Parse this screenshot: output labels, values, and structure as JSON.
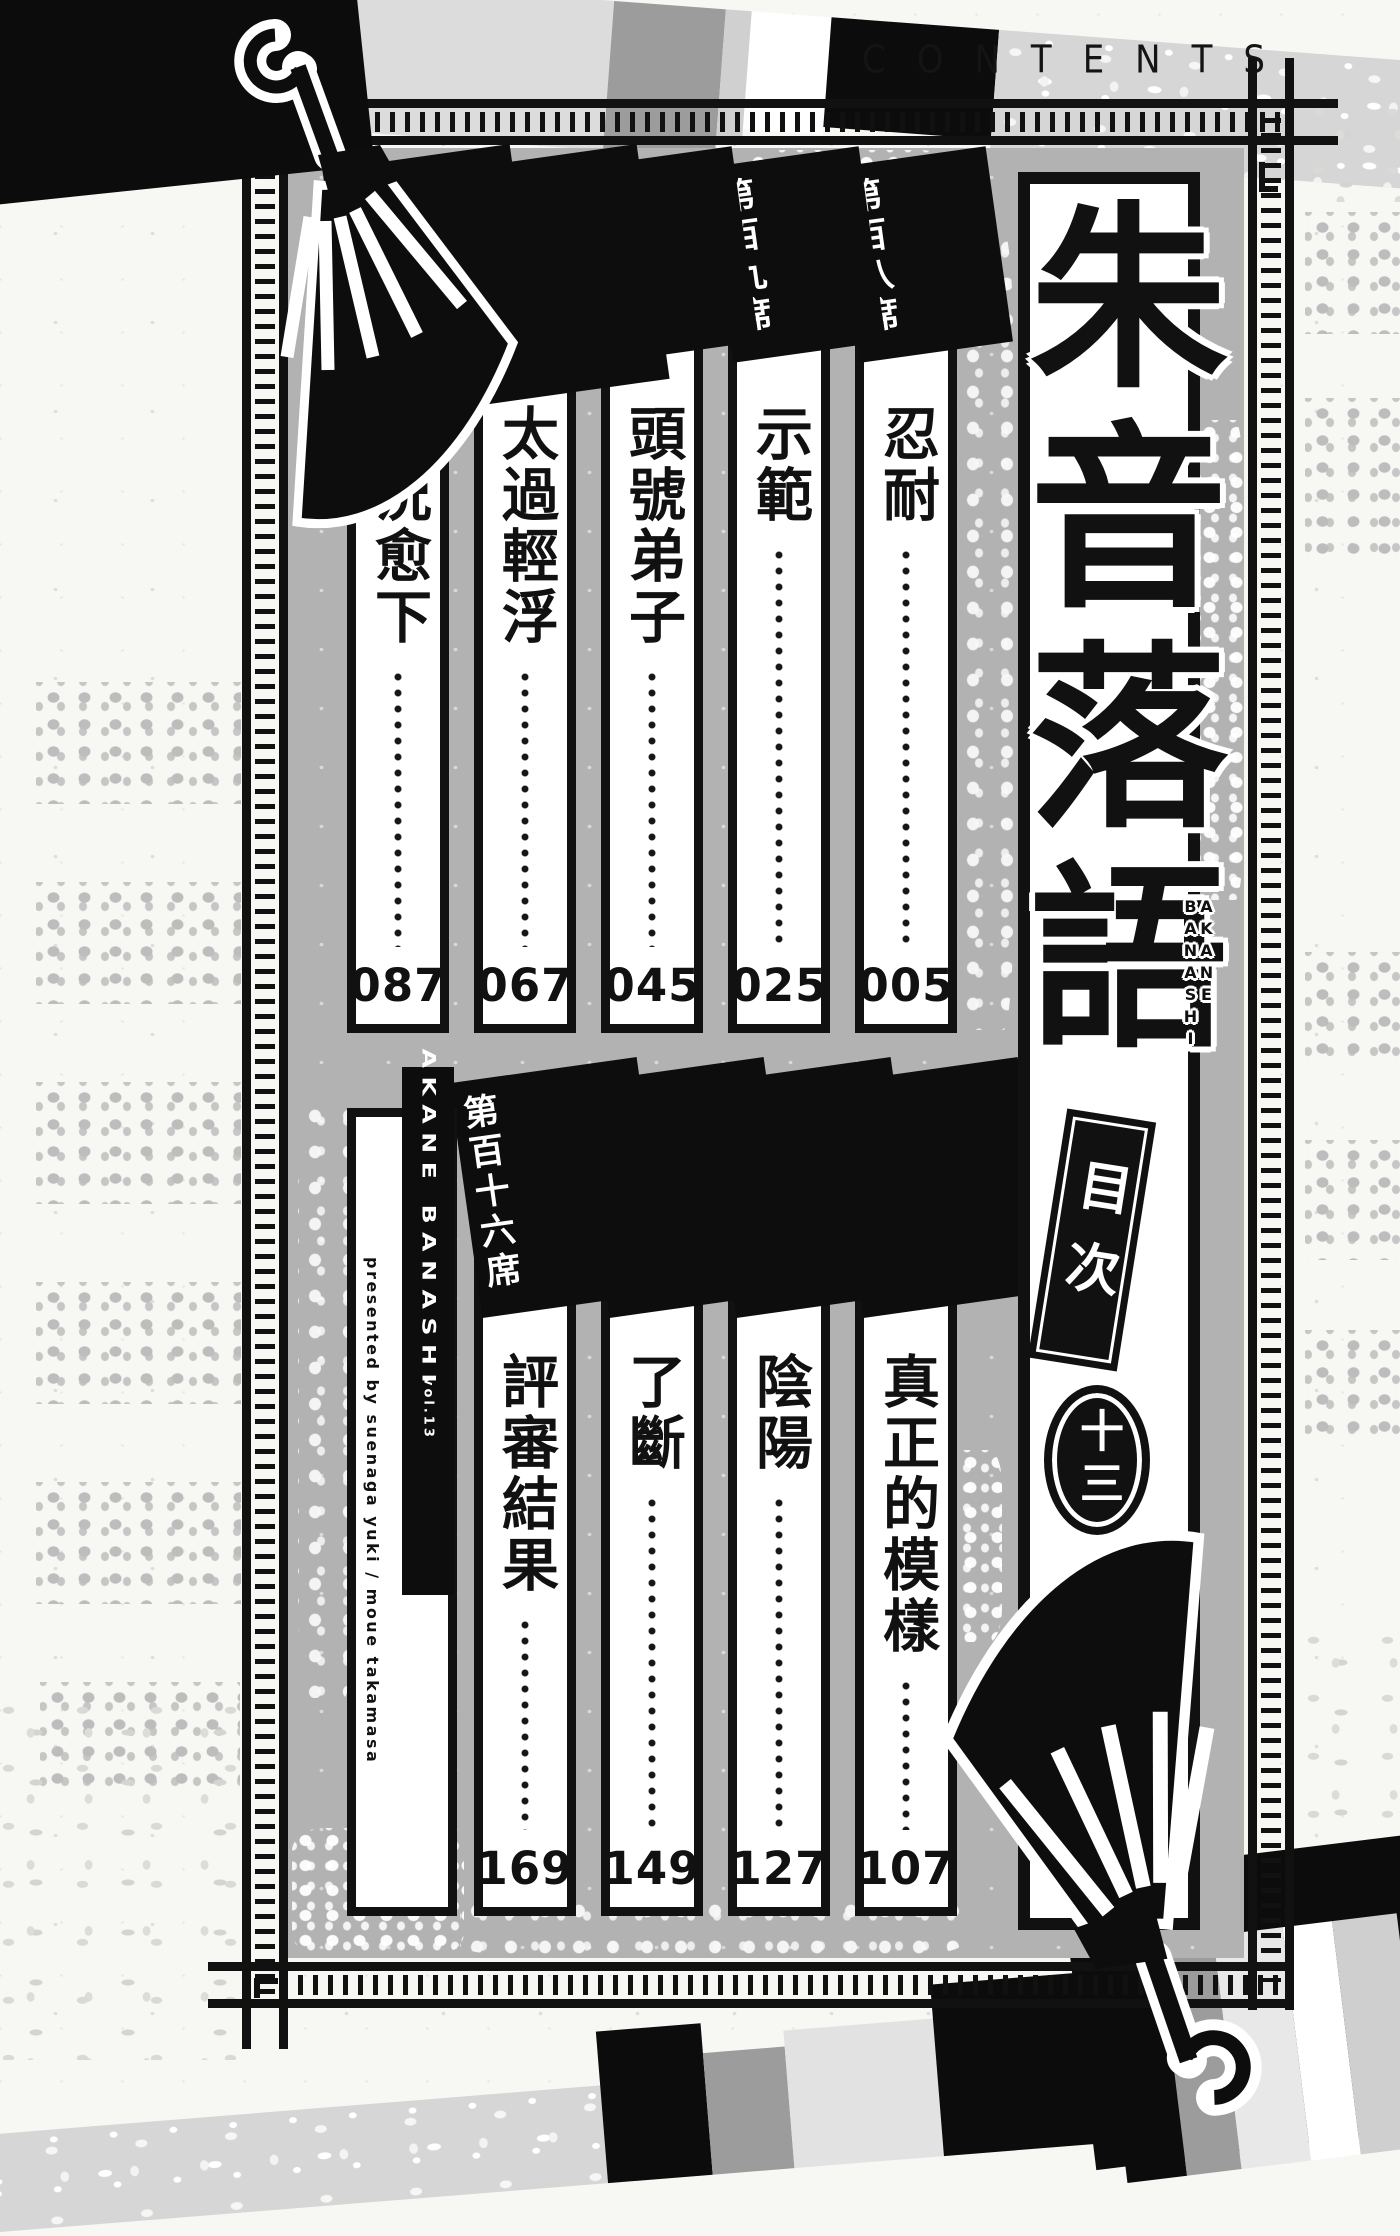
{
  "header": {
    "contents_label": "CONTENTS"
  },
  "title": {
    "main": "朱音落語",
    "romaji_right": "AKANE",
    "romaji_left": "BANASHI",
    "toc_label": "目次",
    "volume_badge": "十三",
    "subtitle": "頭號弟子"
  },
  "chapters_row1": [
    {
      "label": "第百八席",
      "title": "忍耐",
      "page": "005"
    },
    {
      "label": "第百九席",
      "title": "示範",
      "page": "025"
    },
    {
      "label": "第百十席",
      "title": "頭號弟子",
      "page": "045"
    },
    {
      "label": "第百十一席",
      "title": "太過輕浮",
      "page": "067"
    },
    {
      "label": "第百十二席",
      "title": "每況愈下",
      "page": "087"
    }
  ],
  "chapters_row2": [
    {
      "label": "第百十三席",
      "title": "真正的模樣",
      "page": "107"
    },
    {
      "label": "第百十四席",
      "title": "陰陽",
      "page": "127"
    },
    {
      "label": "第百十五席",
      "title": "了斷",
      "page": "149"
    },
    {
      "label": "第百十六席",
      "title": "評審結果",
      "page": "169"
    }
  ],
  "credits": {
    "series": "AKANE BANASHI",
    "volume": "vol.13",
    "presented_by": "presented by suenaga yuki / moue takamasa"
  },
  "colors": {
    "ink": "#111111",
    "panel_gray": "#b2b2b2",
    "paper": "#f7f7f4"
  }
}
